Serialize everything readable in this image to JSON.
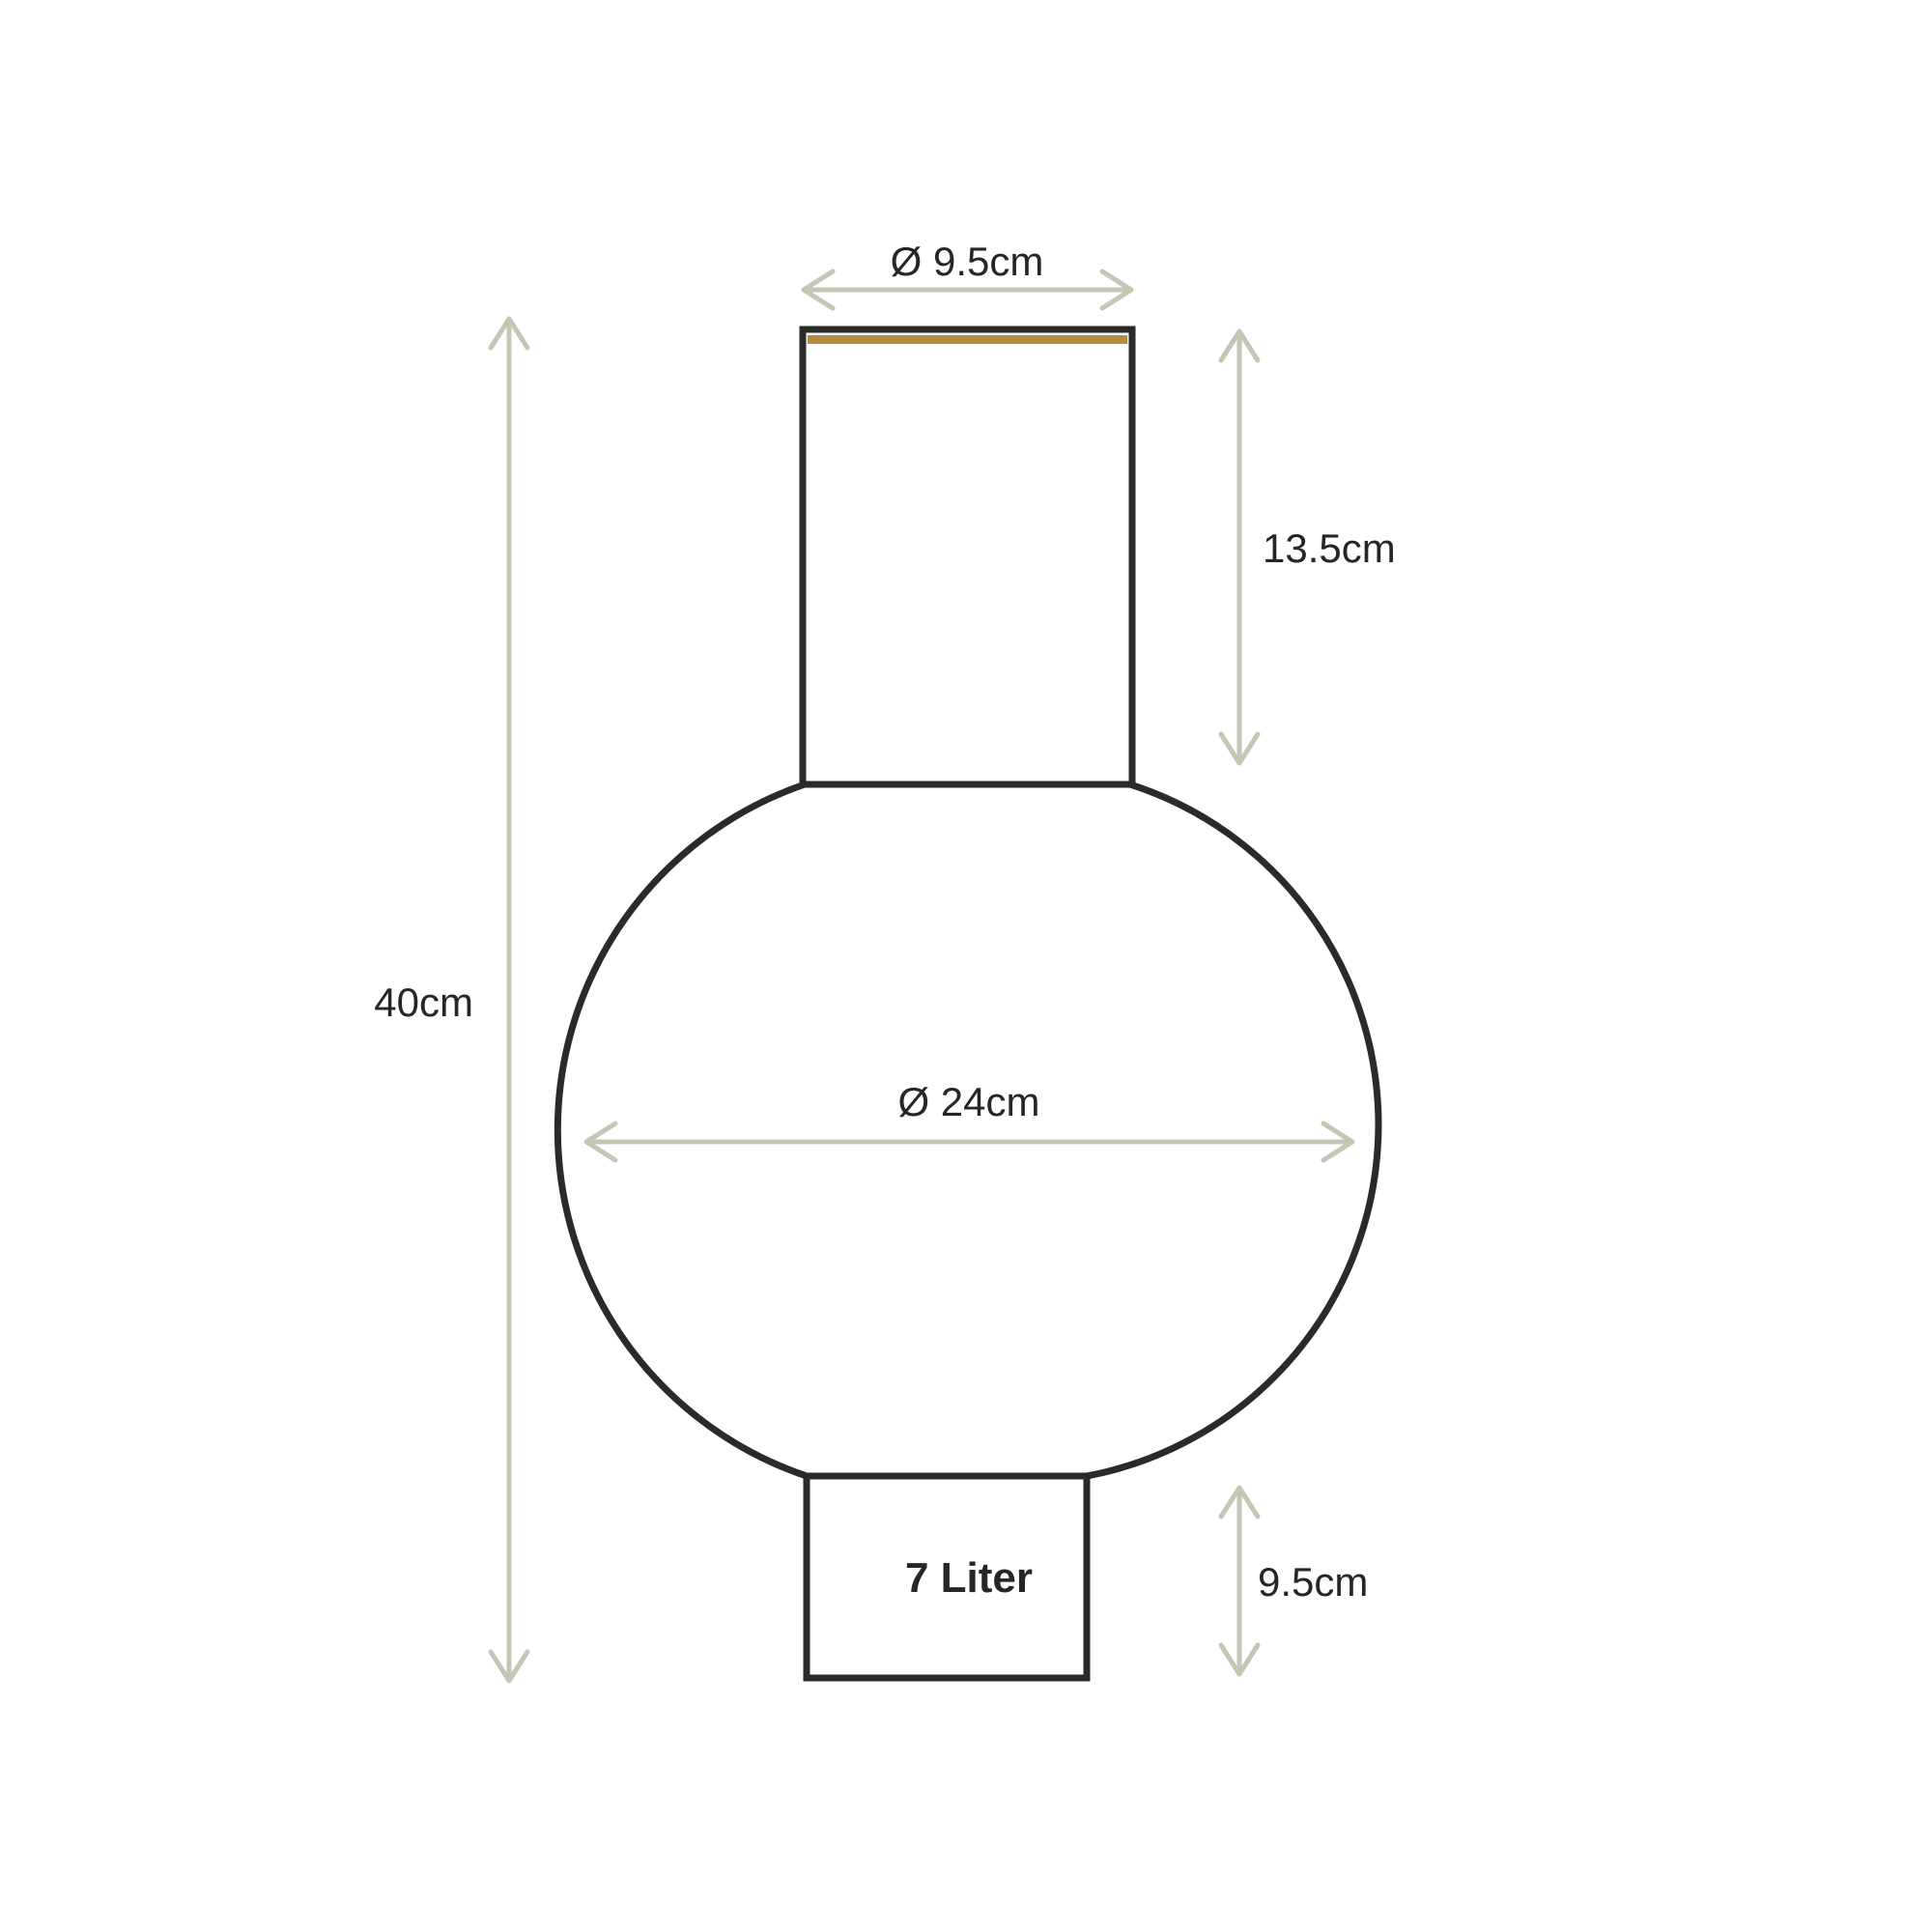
{
  "diagram": {
    "kind": "vase-dimension-drawing",
    "labels": {
      "top_diameter": "Ø 9.5cm",
      "neck_height": "13.5cm",
      "total_height": "40cm",
      "body_diameter": "Ø 24cm",
      "base_height": "9.5cm",
      "capacity": "7 Liter"
    }
  },
  "colors": {
    "outline": "#2b2a28",
    "rim_accent": "#b58a42",
    "dimension_lines": "#c5c7b5",
    "text": "#262626",
    "background": "#ffffff"
  }
}
